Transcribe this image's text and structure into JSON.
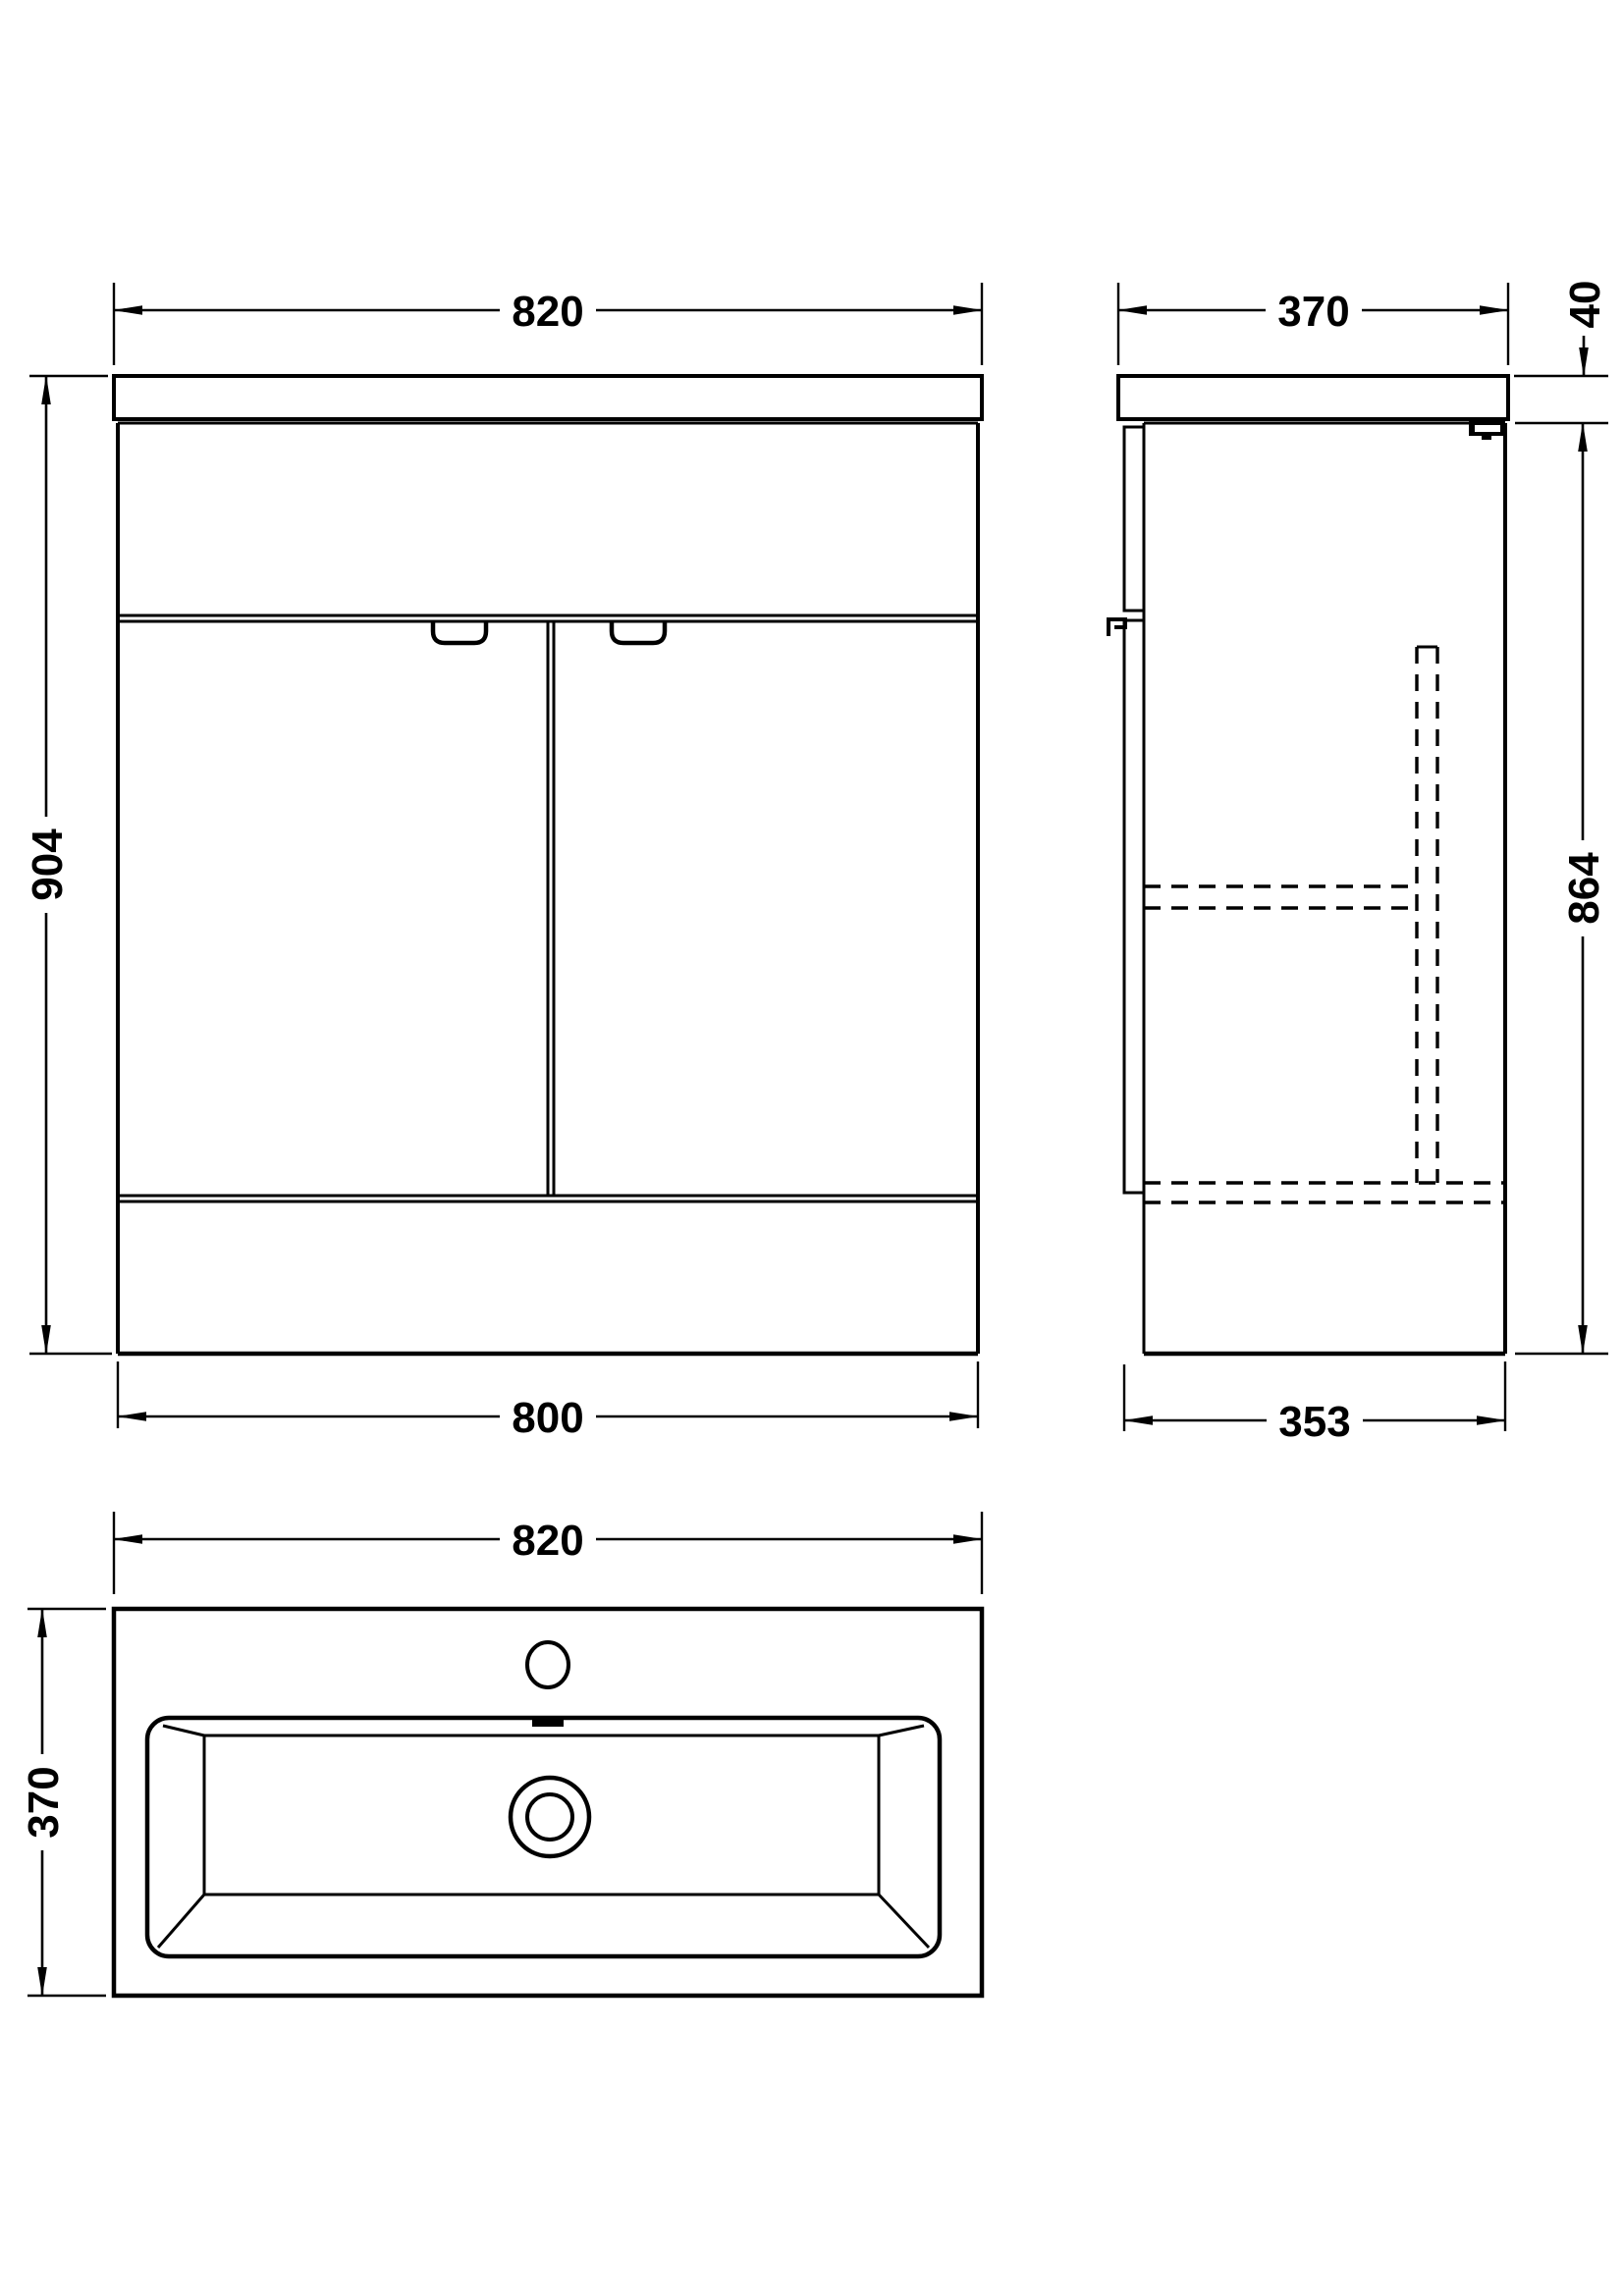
{
  "drawing": {
    "background": "#ffffff",
    "line_color": "#000000",
    "views": {
      "front": {
        "dim_width_top": "820",
        "dim_height": "904",
        "dim_width_bottom": "800"
      },
      "side": {
        "dim_depth_top": "370",
        "dim_worktop_height": "40",
        "dim_body_height": "864",
        "dim_depth_bottom": "353"
      },
      "plan": {
        "dim_width": "820",
        "dim_depth": "370"
      }
    }
  }
}
